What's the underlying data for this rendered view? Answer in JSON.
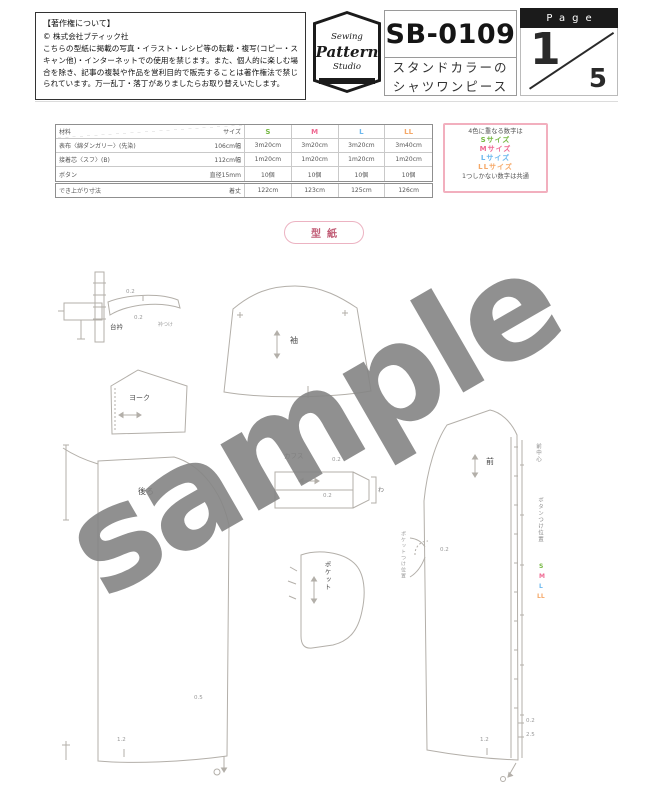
{
  "header": {
    "copyright": {
      "title": "【著作権について】",
      "company": "© 株式会社ブティック社",
      "body": "こちらの型紙に掲載の写真・イラスト・レシピ等の転載・複写(コピー・スキャン他)・インターネットでの使用を禁じます。また、個人的に楽しむ場合を除き、記事の複製や作品を営利目的で販売することは著作権法で禁じられています。万一乱丁・落丁がありましたらお取り替えいたします。"
    },
    "logo": {
      "line1": "Sewing",
      "line2": "Pattern",
      "line3": "Studio"
    },
    "product": {
      "code": "SB-0109",
      "name_line1": "スタンドカラーの",
      "name_line2": "シャツワンピース"
    },
    "page": {
      "label": "Page",
      "current": "1",
      "total": "5"
    }
  },
  "materials_table": {
    "header": {
      "left": "材料",
      "size_label": "サイズ",
      "sizes": [
        "S",
        "M",
        "L",
        "LL"
      ]
    },
    "size_colors": [
      "#76b843",
      "#ef6a93",
      "#6cb8ee",
      "#f5a868"
    ],
    "rows": [
      {
        "label": "表布〈綿ダンガリー〉(先染)",
        "spec": "106cm幅",
        "values": [
          "3m20cm",
          "3m20cm",
          "3m20cm",
          "3m40cm"
        ]
      },
      {
        "label": "接着芯〈スフ〉(B)",
        "spec": "112cm幅",
        "values": [
          "1m20cm",
          "1m20cm",
          "1m20cm",
          "1m20cm"
        ]
      },
      {
        "label": "ボタン",
        "spec": "直径15mm",
        "values": [
          "10個",
          "10個",
          "10個",
          "10個"
        ]
      }
    ],
    "finished_row": {
      "label": "でき上がり寸法",
      "spec": "着丈",
      "values": [
        "122cm",
        "123cm",
        "125cm",
        "126cm"
      ]
    }
  },
  "legend": {
    "line_top": "4色に重なる数字は",
    "sizes": [
      {
        "label": "Sサイズ",
        "color": "#76b843"
      },
      {
        "label": "Mサイズ",
        "color": "#ef6a93"
      },
      {
        "label": "Lサイズ",
        "color": "#6cb8ee"
      },
      {
        "label": "LLサイズ",
        "color": "#f5a868"
      }
    ],
    "line_bottom": "1つしかない数字は共通"
  },
  "pattern_sheet": {
    "tag": "型紙",
    "watermark": "sample",
    "pieces": {
      "collar_band": "台衿",
      "sleeve": "袖",
      "yoke": "ヨーク",
      "cuff": "カフス",
      "pocket": "ポケット",
      "back": "後ろ",
      "front": "前"
    },
    "annotations": {
      "collar_02_top": "0.2",
      "collar_02_bottom": "0.2",
      "collar_attach": "衿つけ",
      "cuff_02_top": "0.2",
      "cuff_02_bottom": "0.2",
      "fold_mark": "わ",
      "back_hem": "1.2",
      "back_corner": "0.5",
      "front_hem": "1.2",
      "front_edge_02": "0.2",
      "front_edge_25": "2.5",
      "pocket_02": "0.2",
      "pocket_position": "ポケットつけ位置",
      "front_center": "前中心",
      "button_position": "ボタンつけ位置",
      "size_s": "S",
      "size_m": "M",
      "size_l": "L",
      "size_ll": "LL"
    }
  }
}
